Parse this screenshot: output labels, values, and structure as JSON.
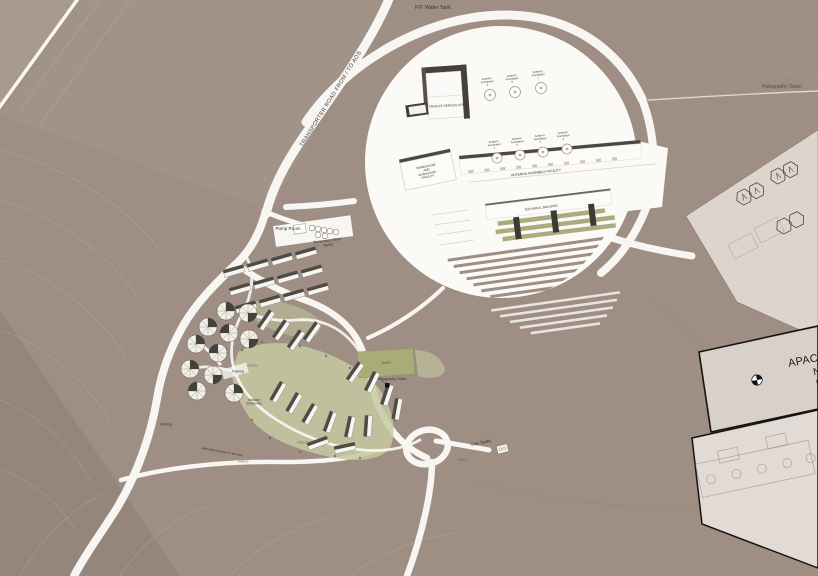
{
  "map": {
    "colors": {
      "terrain": "#9e8e83",
      "road_white": "#f8f6f2",
      "circle_white": "#fbfaf7",
      "sheet_light": "#ddd5cd",
      "sheet_border_black": "#16130f",
      "roof_dark": "#4b4842",
      "olive_green": "#a9ad7e",
      "lawn_green": "#c6c9a2",
      "label_text": "#37332c"
    },
    "labels": {
      "fp_water_tank": "F.P. Water Tank",
      "transporter_road": "TRANSPORTER ROAD FROM / TO AOS",
      "holography_tower_far": "Holography Tower",
      "vehicle_service_area": "VEHICLE SERVICE AREA",
      "warehouse": "WAREHOUSE AND WORKSHOP FACILITY",
      "antenna_assembly": "ANTENNA ASSEMBLY FACILITY",
      "technical_building": "TECHNICAL BUILDING",
      "pump_room": "Pump Room",
      "temporary_water_tanks": "Temporary Water Tanks",
      "tennis": "Tennis",
      "holography_tower": "Holography Tower",
      "parking": "Parking",
      "parking_west": "Parking",
      "modular_dormitories": "Modular dormitories",
      "gas_tanks": "Gas Tanks",
      "alternative_entrance": "Alternative entrance to the area",
      "apacheta": "APACHETA",
      "coord_north": "N 7.448",
      "coord_east": "E 604.3"
    },
    "antenna_foundations_top": [
      "Antenna Foundation 5",
      "Antenna Foundation 6",
      "Antenna Foundation 7"
    ],
    "antenna_foundations_mid": [
      "Antenna Foundation 1",
      "Antenna Foundation 2",
      "Antenna Foundation 3",
      "Antenna Foundation 4"
    ],
    "elevation_marks": [
      "+4800.00",
      "+4800.00",
      "+4800.00",
      "+4800.00"
    ]
  }
}
